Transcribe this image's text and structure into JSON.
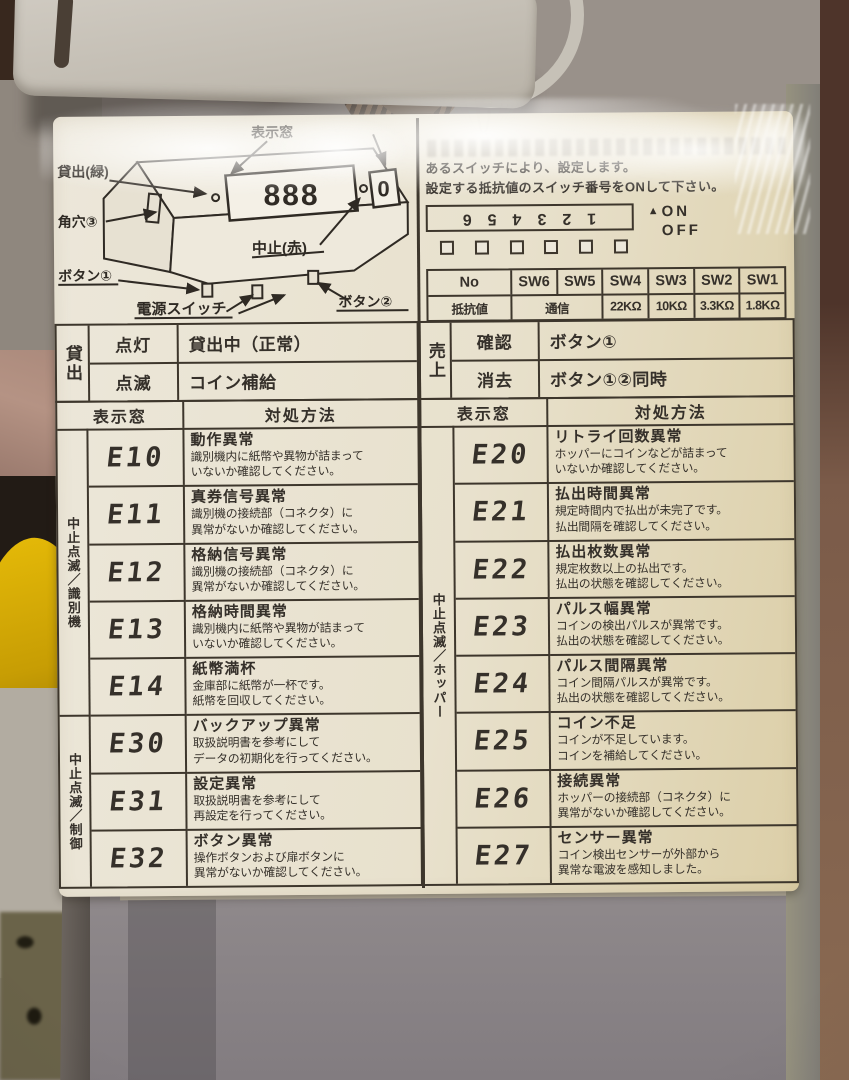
{
  "diagram": {
    "label_lend_green": "貸出(緑)",
    "label_square_hole": "角穴③",
    "label_button1": "ボタン①",
    "label_power_switch": "電源スイッチ",
    "label_button2": "ボタン②",
    "label_display_window": "表示窓",
    "label_stop_red": "中止(赤)",
    "display_digits": "888",
    "sub_display_digit": "0"
  },
  "settings": {
    "line1": "あるスイッチにより、設定します。",
    "line2": "設定する抵抗値のスイッチ番号をONして下さい。",
    "dip_numbers": "123456",
    "on_label": "ON",
    "off_label": "OFF",
    "sw_header": [
      "No",
      "SW6",
      "SW5",
      "SW4",
      "SW3",
      "SW2",
      "SW1"
    ],
    "sw_row_label": "抵抗値",
    "sw_comm": "通信",
    "sw_values": [
      "22KΩ",
      "10KΩ",
      "3.3KΩ",
      "1.8KΩ"
    ]
  },
  "status": {
    "lend_label": "貸出",
    "lend_rows": [
      {
        "state": "点灯",
        "desc": "貸出中（正常）"
      },
      {
        "state": "点滅",
        "desc": "コイン補給"
      }
    ],
    "sales_label": "売上",
    "sales_rows": [
      {
        "state": "確認",
        "desc": "ボタン①"
      },
      {
        "state": "消去",
        "desc": "ボタン①②同時"
      }
    ]
  },
  "errors": {
    "header_display": "表示窓",
    "header_action": "対処方法",
    "left_groups": [
      {
        "side_label": "中止点滅／識別機",
        "rows": [
          {
            "code": "E10",
            "title": "動作異常",
            "desc": "識別機内に紙幣や異物が詰まって\nいないか確認してください。"
          },
          {
            "code": "E11",
            "title": "真券信号異常",
            "desc": "識別機の接続部（コネクタ）に\n異常がないか確認してください。"
          },
          {
            "code": "E12",
            "title": "格納信号異常",
            "desc": "識別機の接続部（コネクタ）に\n異常がないか確認してください。"
          },
          {
            "code": "E13",
            "title": "格納時間異常",
            "desc": "識別機内に紙幣や異物が詰まって\nいないか確認してください。"
          },
          {
            "code": "E14",
            "title": "紙幣満杯",
            "desc": "金庫部に紙幣が一杯です。\n紙幣を回収してください。"
          }
        ]
      },
      {
        "side_label": "中止点滅／制御",
        "rows": [
          {
            "code": "E30",
            "title": "バックアップ異常",
            "desc": "取扱説明書を参考にして\nデータの初期化を行ってください。"
          },
          {
            "code": "E31",
            "title": "設定異常",
            "desc": "取扱説明書を参考にして\n再設定を行ってください。"
          },
          {
            "code": "E32",
            "title": "ボタン異常",
            "desc": "操作ボタンおよび扉ボタンに\n異常がないか確認してください。"
          }
        ]
      }
    ],
    "right_group": {
      "side_label": "中止点滅／ホッパー",
      "rows": [
        {
          "code": "E20",
          "title": "リトライ回数異常",
          "desc": "ホッパーにコインなどが詰まって\nいないか確認してください。"
        },
        {
          "code": "E21",
          "title": "払出時間異常",
          "desc": "規定時間内で払出が未完了です。\n払出間隔を確認してください。"
        },
        {
          "code": "E22",
          "title": "払出枚数異常",
          "desc": "規定枚数以上の払出です。\n払出の状態を確認してください。"
        },
        {
          "code": "E23",
          "title": "パルス幅異常",
          "desc": "コインの検出パルスが異常です。\n払出の状態を確認してください。"
        },
        {
          "code": "E24",
          "title": "パルス間隔異常",
          "desc": "コイン間隔パルスが異常です。\n払出の状態を確認してください。"
        },
        {
          "code": "E25",
          "title": "コイン不足",
          "desc": "コインが不足しています。\nコインを補給してください。"
        },
        {
          "code": "E26",
          "title": "接続異常",
          "desc": "ホッパーの接続部（コネクタ）に\n異常がないか確認してください。"
        },
        {
          "code": "E27",
          "title": "センサー異常",
          "desc": "コイン検出センサーが外部から\n異常な電波を感知しました。"
        }
      ]
    }
  }
}
